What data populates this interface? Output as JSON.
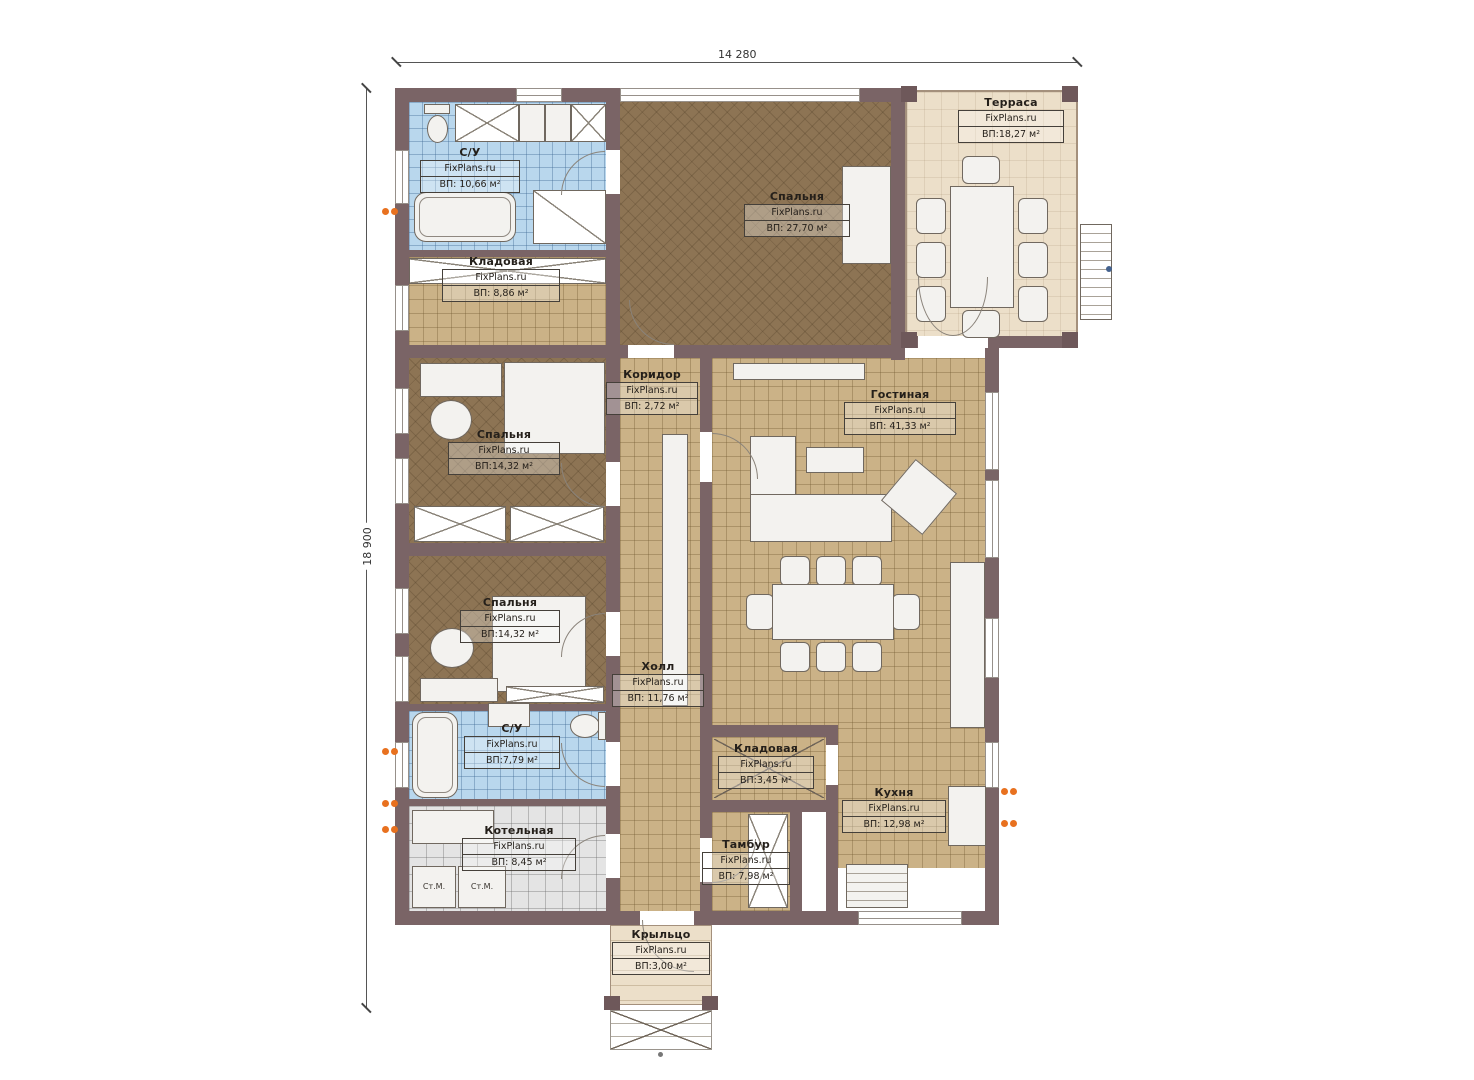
{
  "plan": {
    "width_label": "14 280",
    "height_label": "18 900"
  },
  "labels": {
    "brand": "FixPlans.ru",
    "washer": "Ст.М."
  },
  "rooms": {
    "bath_top": {
      "name": "С/У",
      "area": "ВП: 10,66 м²"
    },
    "storage_top": {
      "name": "Кладовая",
      "area": "ВП: 8,86 м²"
    },
    "bedroom_top": {
      "name": "Спальня",
      "area": "ВП: 27,70 м²"
    },
    "terrace": {
      "name": "Терраса",
      "area": "ВП:18,27 м²"
    },
    "corridor": {
      "name": "Коридор",
      "area": "ВП: 2,72 м²"
    },
    "living": {
      "name": "Гостиная",
      "area": "ВП: 41,33 м²"
    },
    "bedroom_mid": {
      "name": "Спальня",
      "area": "ВП:14,32 м²"
    },
    "bedroom_low": {
      "name": "Спальня",
      "area": "ВП:14,32 м²"
    },
    "hall": {
      "name": "Холл",
      "area": "ВП: 11,76 м²"
    },
    "bath_low": {
      "name": "С/У",
      "area": "ВП:7,79 м²"
    },
    "storage_low": {
      "name": "Кладовая",
      "area": "ВП:3,45 м²"
    },
    "kitchen": {
      "name": "Кухня",
      "area": "ВП: 12,98 м²"
    },
    "tambur": {
      "name": "Тамбур",
      "area": "ВП: 7,98 м²"
    },
    "boiler": {
      "name": "Котельная",
      "area": "ВП: 8,45 м²"
    },
    "porch": {
      "name": "Крыльцо",
      "area": "ВП:3,00 м²"
    }
  },
  "colors": {
    "wall": "#7a6466",
    "floor_tan": "#cbb287",
    "floor_dark": "#8d7454",
    "floor_blue": "#b9d7ed",
    "floor_gray": "#e4e4e4",
    "floor_cream": "#ecdfc9",
    "accent_orange": "#e8711f"
  }
}
